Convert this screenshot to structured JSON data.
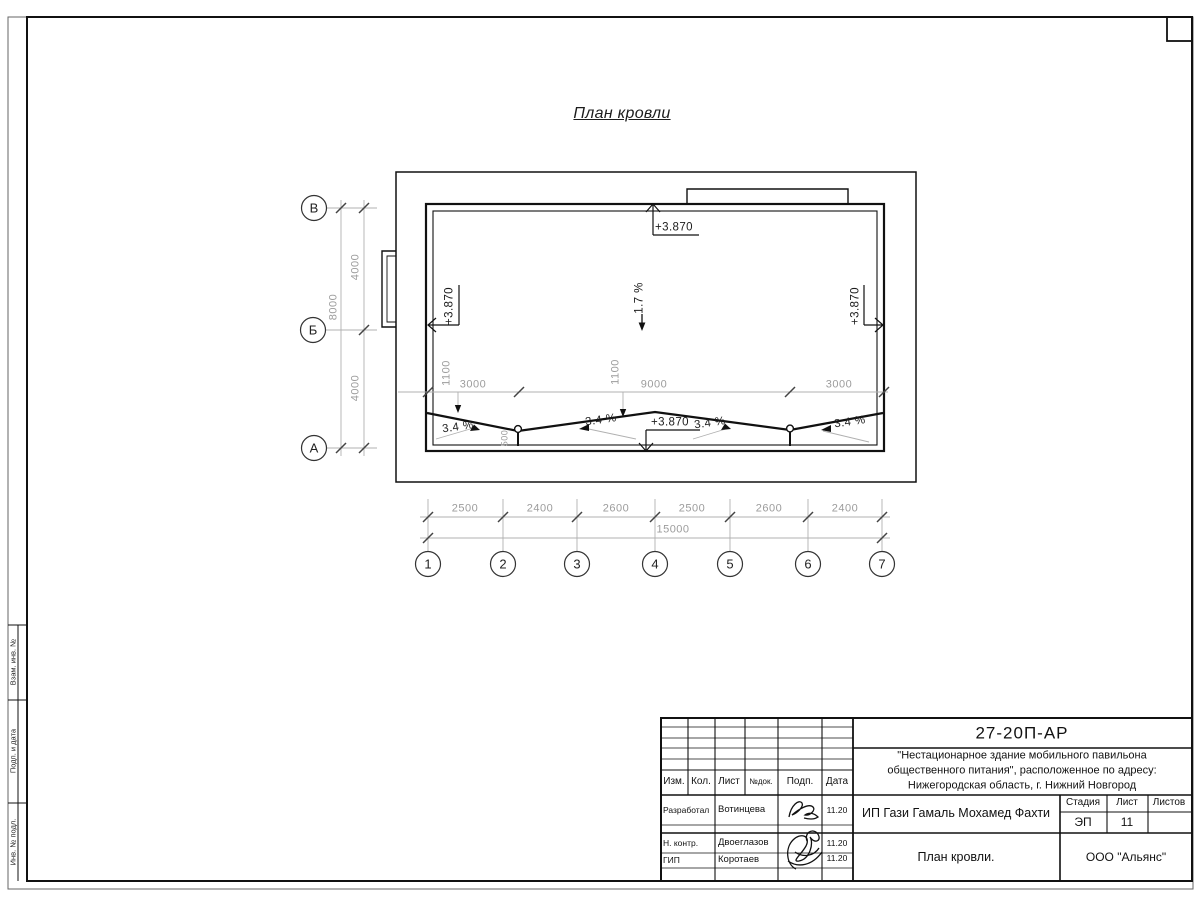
{
  "page": {
    "title": "План кровли"
  },
  "axes": {
    "rows": [
      "В",
      "Б",
      "А"
    ],
    "cols": [
      "1",
      "2",
      "3",
      "4",
      "5",
      "6",
      "7"
    ]
  },
  "dims": {
    "bottom_chain": [
      "2500",
      "2400",
      "2600",
      "2500",
      "2600",
      "2400"
    ],
    "bottom_total": "15000",
    "left_chain": [
      "4000",
      "4000"
    ],
    "left_total": "8000",
    "inner_h": [
      "3000",
      "9000",
      "3000"
    ],
    "inner_v": [
      "1100",
      "1100"
    ],
    "drain_offset": "500"
  },
  "marks": {
    "elevation": "+3.870",
    "slope_main": "1.7 %",
    "slope_local": "3.4 %"
  },
  "titleblock": {
    "doc_number": "27-20П-АР",
    "project": [
      "\"Нестационарное здание мобильного павильона",
      "общественного питания\", расположенное по адресу:",
      "Нижегородская область, г. Нижний Новгород"
    ],
    "client": "ИП Гази Гамаль Мохамед Фахти",
    "drawing_title": "План кровли.",
    "company": "ООО \"Альянс\"",
    "stage_label": "Стадия",
    "stage_value": "ЭП",
    "sheet_label": "Лист",
    "sheet_value": "11",
    "sheets_label": "Листов",
    "cols": [
      "Изм.",
      "Кол.",
      "Лист",
      "№док.",
      "Подп.",
      "Дата"
    ],
    "rows": [
      {
        "role": "Разработал",
        "name": "Вотинцева",
        "date": "11.20"
      },
      {
        "role": "Н. контр.",
        "name": "Двоеглазов",
        "date": "11.20"
      },
      {
        "role": "ГИП",
        "name": "Коротаев",
        "date": "11.20"
      }
    ]
  },
  "frame": {
    "side_labels": [
      "Взам. инв. №",
      "Подп. и дата",
      "Инв. № подл."
    ]
  },
  "colors": {
    "line_main": "#111111",
    "line_dim": "#b0b0b0",
    "tick": "#444444",
    "text_dim": "#9c9c9c",
    "text_main": "#1c1c1c"
  }
}
